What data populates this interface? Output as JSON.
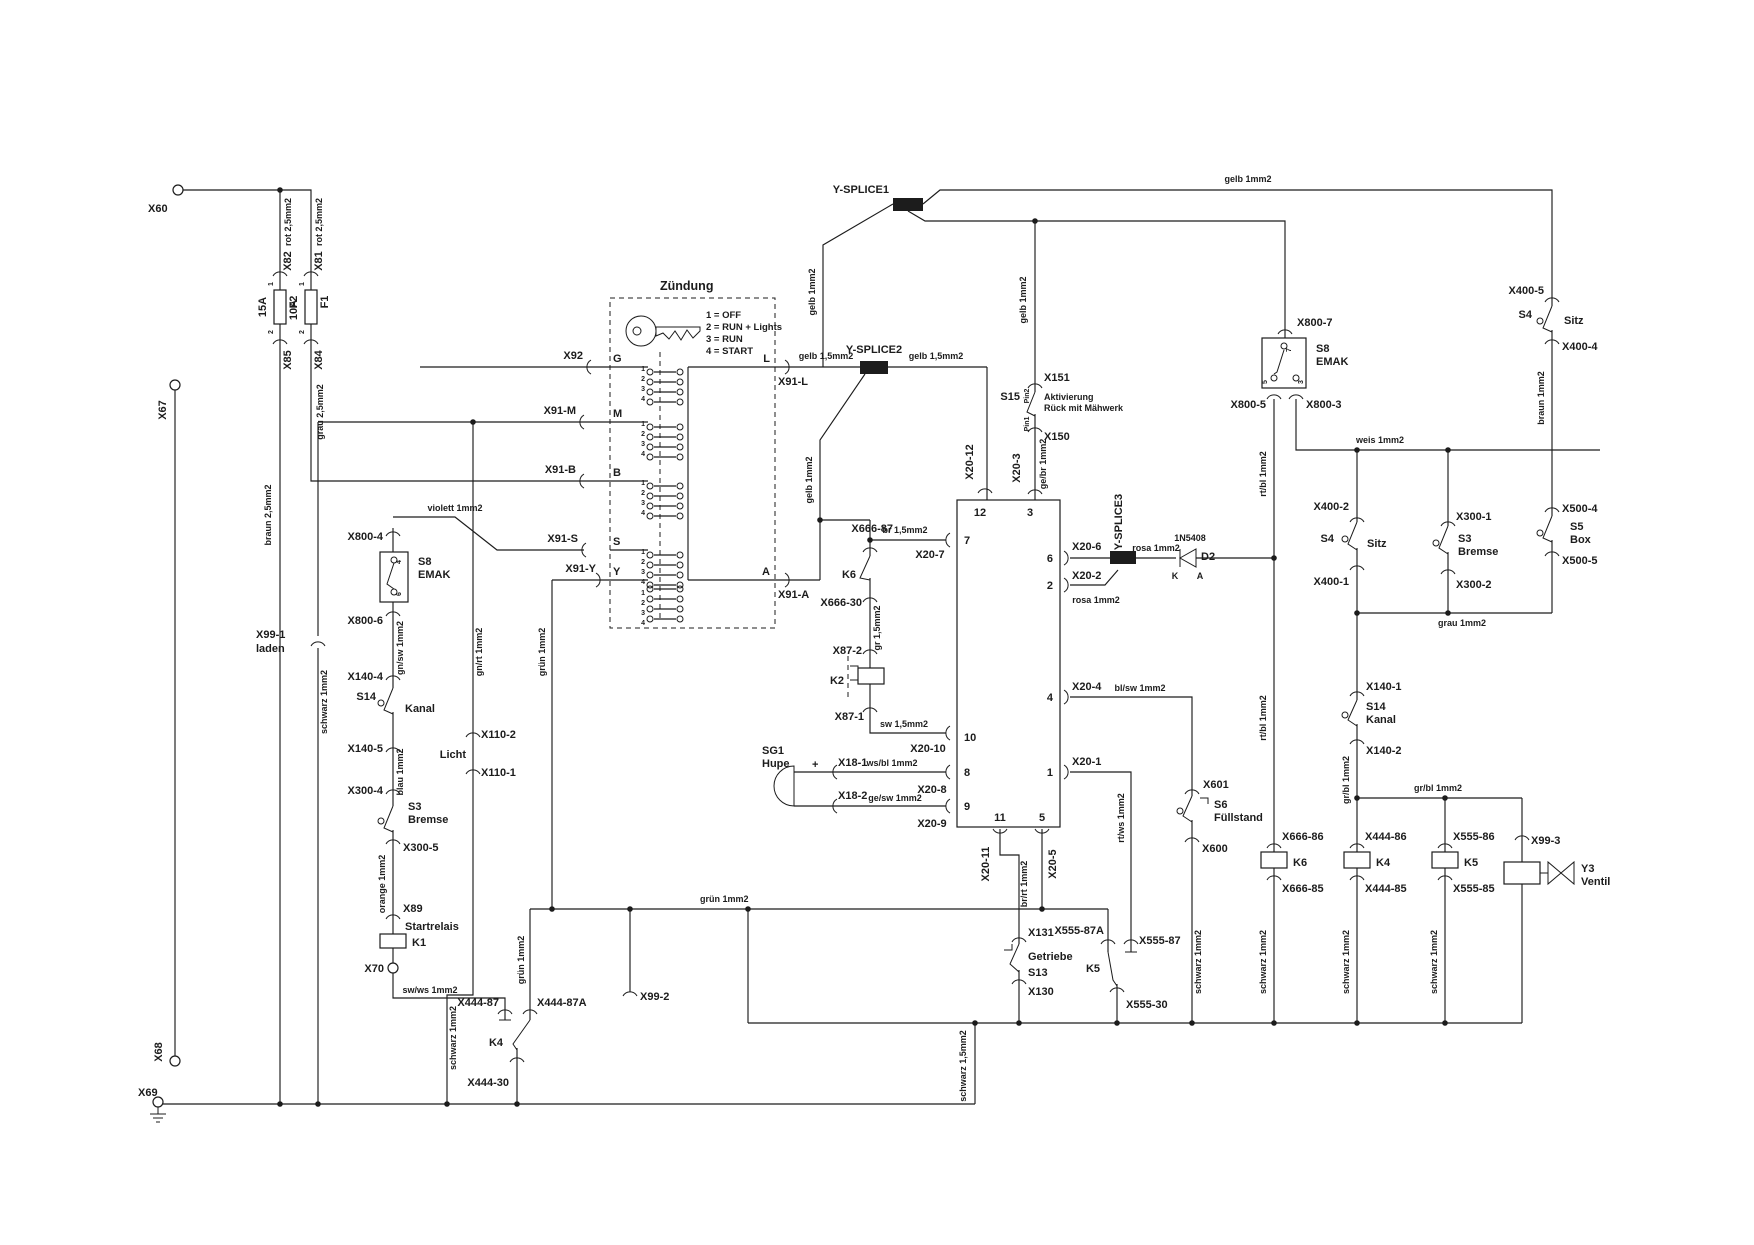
{
  "meta": {
    "type": "wiring-schematic",
    "subject": "Zünd- und Sicherheitsschaltplan (EMAK Aufsitzmäher)"
  },
  "colors": {
    "ink": "#1c1c1c",
    "bg": "#ffffff"
  },
  "supply": {
    "x60": "X60",
    "x67": "X67",
    "x68": "X68",
    "x69": "X69",
    "f2": {
      "wire_in": "rot 2,5mm2",
      "conn_in": "X82",
      "pin_in": "1",
      "rating": "15A",
      "name": "F2",
      "pin_out": "2",
      "conn_out": "X85",
      "wire_out": "braun 2,5mm2"
    },
    "f1": {
      "wire_in": "rot 2,5mm2",
      "conn_in": "X81",
      "pin_in": "1",
      "rating": "10A",
      "name": "F1",
      "pin_out": "2",
      "conn_out": "X84",
      "wire_out": "grau 2,5mm2"
    }
  },
  "charge": {
    "conn": "X99-1",
    "label": "laden",
    "wire": "schwarz 1mm2"
  },
  "ignition": {
    "title": "Zündung",
    "legend": [
      "1 = OFF",
      "2 = RUN + Lights",
      "3 = RUN",
      "4 = START"
    ],
    "cn": [
      "1",
      "2",
      "3",
      "4"
    ],
    "term": {
      "g": "G",
      "m": "M",
      "b": "B",
      "s": "S",
      "y": "Y",
      "l": "L",
      "a": "A"
    },
    "plug": {
      "g": "X92",
      "m": "X91-M",
      "b": "X91-B",
      "s": "X91-S",
      "y": "X91-Y",
      "l": "X91-L",
      "a": "X91-A"
    }
  },
  "splice": {
    "s1": "Y-SPLICE1",
    "s2": "Y-SPLICE2",
    "s3": "Y-SPLICE3"
  },
  "wire": {
    "gelb1_top": "gelb 1mm2",
    "gelb1_s1left": "gelb 1mm2",
    "gelb1_s15": "gelb 1mm2",
    "gelb1_a": "gelb 1mm2",
    "gelb15_l": "gelb 1,5mm2",
    "gelb15_r": "gelb 1,5mm2",
    "violett": "violett 1mm2",
    "gnsw": "gn/sw 1mm2",
    "blau": "blau 1mm2",
    "orange": "orange 1mm2",
    "swws": "sw/ws 1mm2",
    "gnrt": "gn/rt 1mm2",
    "schwarz_licht": "schwarz 1mm2",
    "gruen_v": "grün 1mm2",
    "gruen_bus": "grün 1mm2",
    "gruen_87a": "grün 1mm2",
    "gebr": "ge/br 1mm2",
    "br15": "br 1,5mm2",
    "gr15": "gr 1,5mm2",
    "sw15": "sw 1,5mm2",
    "wsbl": "ws/bl 1mm2",
    "gesw": "ge/sw 1mm2",
    "rosa_r": "rosa 1mm2",
    "rosa_b": "rosa 1mm2",
    "blsw": "bl/sw 1mm2",
    "rtws": "rt/ws 1mm2",
    "brrt": "br/rt 1mm2",
    "rtbl_o": "rt/bl 1mm2",
    "rtbl_u": "rt/bl 1mm2",
    "weis": "weis 1mm2",
    "braun1": "braun 1mm2",
    "grau1": "grau 1mm2",
    "grbl_v": "gr/bl 1mm2",
    "grbl_h": "gr/bl 1mm2",
    "schwarz_x600": "schwarz 1mm2",
    "schwarz_k6": "schwarz 1mm2",
    "schwarz_k4": "schwarz 1mm2",
    "schwarz_k5": "schwarz 1mm2",
    "schwarz15": "schwarz 1,5mm2"
  },
  "s15": {
    "conn_top": "X151",
    "pin_top": "Pin2",
    "name": "S15",
    "l1": "Aktivierung",
    "l2": "Rück mit Mähwerk",
    "pin_bot": "Pin1",
    "conn_bot": "X150"
  },
  "emak_l": {
    "conn_top": "X800-4",
    "s8": "S8",
    "name": "EMAK",
    "p4": "4",
    "p6": "6",
    "conn_bot": "X800-6"
  },
  "kanal_l": {
    "conn_top": "X140-4",
    "s14": "S14",
    "name": "Kanal",
    "conn_bot": "X140-5"
  },
  "bremse_l": {
    "conn_top": "X300-4",
    "s3": "S3",
    "name": "Bremse",
    "conn_bot": "X300-5"
  },
  "startrelais": {
    "conn_top": "X89",
    "label": "Startrelais",
    "k1": "K1",
    "x70": "X70"
  },
  "k4c": {
    "c87": "X444-87",
    "c87a": "X444-87A",
    "k4": "K4",
    "c30": "X444-30"
  },
  "licht": {
    "conn_top": "X110-2",
    "label": "Licht",
    "conn_bot": "X110-1"
  },
  "x99_2": "X99-2",
  "ctrl": {
    "pins": {
      "p12": "12",
      "p3": "3",
      "p7": "7",
      "p10": "10",
      "p8": "8",
      "p9": "9",
      "p6": "6",
      "p2": "2",
      "p4": "4",
      "p1": "1",
      "p11": "11",
      "p5": "5"
    },
    "plugs": {
      "p12": "X20-12",
      "p3": "X20-3",
      "p7": "X20-7",
      "p10": "X20-10",
      "p8": "X20-8",
      "p9": "X20-9",
      "p6": "X20-6",
      "p2": "X20-2",
      "p4": "X20-4",
      "p1": "X20-1",
      "p11": "X20-11",
      "p5": "X20-5"
    }
  },
  "k6b": {
    "c87": "X666-87",
    "k6": "K6",
    "c30": "X666-30",
    "c87_2": "X87-2",
    "k2": "K2",
    "c87_1": "X87-1"
  },
  "horn": {
    "sg1": "SG1",
    "name": "Hupe",
    "plus": "+",
    "x18_1": "X18-1",
    "x18_2": "X18-2"
  },
  "diode": {
    "part": "1N5408",
    "name": "D2",
    "k": "K",
    "a": "A"
  },
  "emak_r": {
    "conn_top": "X800-7",
    "s8": "S8",
    "name": "EMAK",
    "p7": "7",
    "p5": "5",
    "p3": "3",
    "conn_l": "X800-5",
    "conn_r": "X800-3"
  },
  "sitz_r": {
    "conn_top": "X400-5",
    "s4": "S4",
    "name": "Sitz",
    "conn_bot": "X400-4"
  },
  "box_r": {
    "conn_top": "X500-4",
    "s5": "S5",
    "name": "Box",
    "conn_bot": "X500-5"
  },
  "sitz_m": {
    "conn_top": "X400-2",
    "s4": "S4",
    "name": "Sitz",
    "conn_bot": "X400-1"
  },
  "bremse_r": {
    "conn_top": "X300-1",
    "s3": "S3",
    "name": "Bremse",
    "conn_bot": "X300-2"
  },
  "kanal_r": {
    "conn_top": "X140-1",
    "s14": "S14",
    "name": "Kanal",
    "conn_bot": "X140-2"
  },
  "fuel": {
    "conn_top": "X601",
    "s6": "S6",
    "name": "Füllstand",
    "conn_bot": "X600"
  },
  "gear": {
    "conn_top": "X131",
    "label": "Getriebe",
    "s13": "S13",
    "conn_bot": "X130"
  },
  "k5c": {
    "c87a": "X555-87A",
    "c87": "X555-87",
    "k5": "K5",
    "c30": "X555-30"
  },
  "coil_k6": {
    "top": "X666-86",
    "name": "K6",
    "bot": "X666-85"
  },
  "coil_k4": {
    "top": "X444-86",
    "name": "K4",
    "bot": "X444-85"
  },
  "coil_k5": {
    "top": "X555-86",
    "name": "K5",
    "bot": "X555-85"
  },
  "valve": {
    "conn": "X99-3",
    "y3": "Y3",
    "name": "Ventil"
  }
}
